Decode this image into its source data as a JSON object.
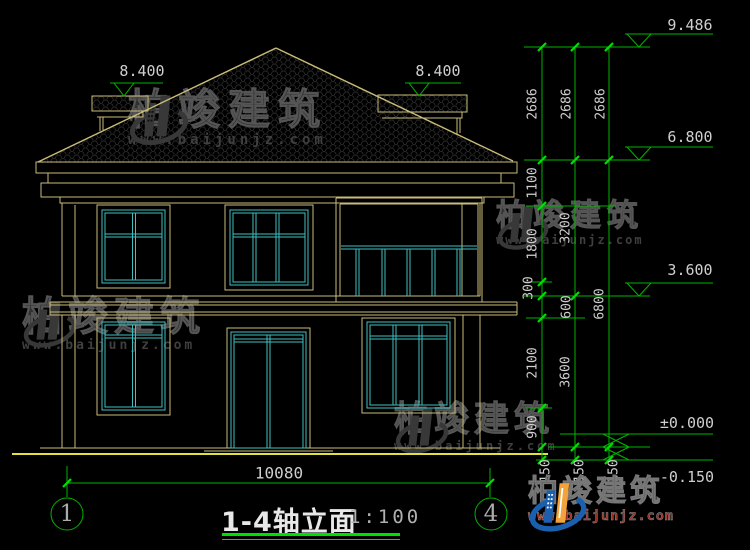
{
  "drawing": {
    "levels": {
      "ridge": "9.486",
      "left_ridge": "8.400",
      "right_ridge": "8.400",
      "eave": "6.800",
      "second_floor": "3.600",
      "first_floor": "±0.000",
      "ground": "-0.150"
    },
    "dim_chains": {
      "inner": [
        "2686",
        "1100",
        "1800",
        "300",
        "600",
        "2100",
        "900",
        "150"
      ],
      "middle": [
        "2686",
        "3200",
        "3600",
        "150"
      ],
      "outer": [
        "2686",
        "6800",
        "150"
      ]
    },
    "width_dim": "10080",
    "axis_left": "1",
    "axis_right": "4",
    "title": "1-4轴立面",
    "scale": "1:100"
  },
  "watermark": {
    "name": "柏竣建筑",
    "url": "www.baijunjz.com"
  },
  "logo": {
    "name": "柏竣建筑",
    "url": "www.baijunjz.com"
  },
  "colors": {
    "green": "#00b400",
    "green-bright": "#00e000",
    "khaki": "#c9bc7a",
    "cyan": "#3fbfbf",
    "yellow": "#e2e23a",
    "text": "#cfcfcf",
    "wm": "#383838",
    "logo-blue": "#1b5faf",
    "logo-orange": "#f2a33c",
    "logo-red": "#9b2b1f"
  }
}
